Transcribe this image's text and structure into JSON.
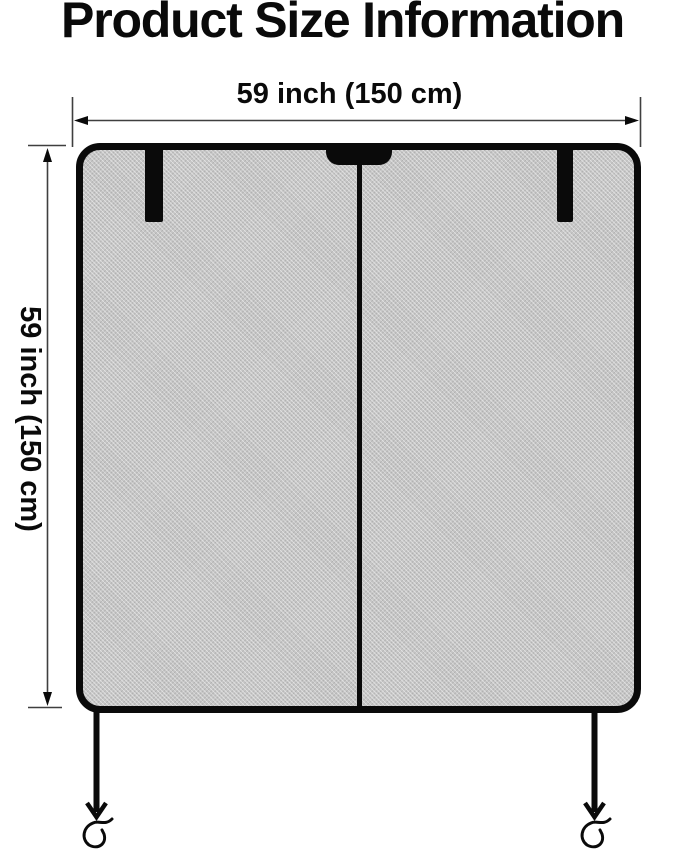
{
  "title": "Product Size Information",
  "dimensions": {
    "width": {
      "label": "59 inch (150 cm)"
    },
    "height": {
      "label": "59 inch (150 cm)"
    }
  },
  "product": {
    "description": "mesh screen panel with two top straps, top handle notch, center zipper divider, two legs with S-hooks"
  },
  "colors": {
    "ink": "#0a0a0a",
    "dimension_line": "#3f3f3f",
    "mesh": "#c6c6c6",
    "background": "#ffffff"
  }
}
